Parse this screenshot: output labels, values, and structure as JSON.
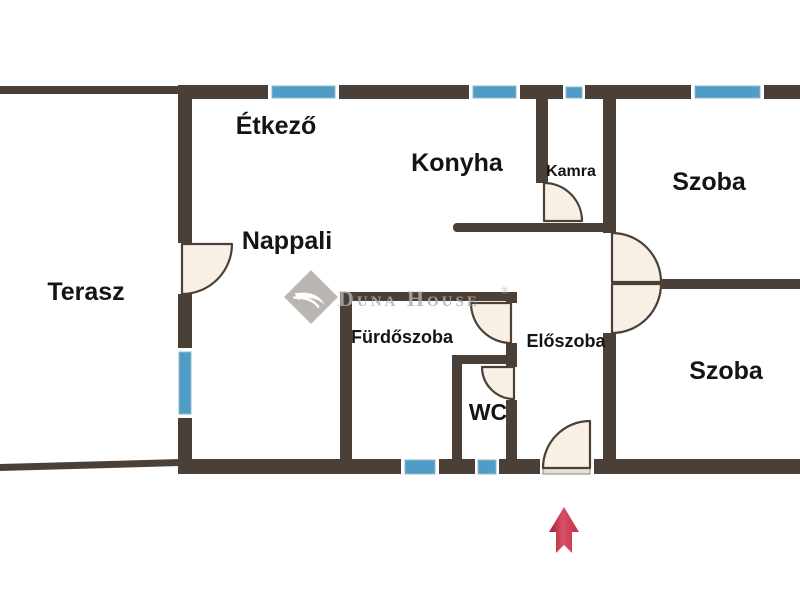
{
  "page": {
    "description": "Apartment floor plan drawing with Hungarian room labels and agency watermark"
  },
  "colors": {
    "background": "#ffffff",
    "wall": "#4a4037",
    "window": "#4f9dc6",
    "window_border": "#95b8c8",
    "door_fill": "#f8f0e5",
    "door_sill": "#e9e1d3",
    "label": "#141414",
    "watermark": "#b4afa9",
    "arrow_dark": "#9e2038",
    "arrow_mid": "#d94f63",
    "arrow_edge": "#c23049"
  },
  "rooms": [
    {
      "name": "etkezo",
      "label": "Étkező"
    },
    {
      "name": "konyha",
      "label": "Konyha"
    },
    {
      "name": "kamra",
      "label": "Kamra"
    },
    {
      "name": "szoba-top",
      "label": "Szoba"
    },
    {
      "name": "nappali",
      "label": "Nappali"
    },
    {
      "name": "terasz",
      "label": "Terasz"
    },
    {
      "name": "furdoszoba",
      "label": "Fürdőszoba"
    },
    {
      "name": "eloszoba",
      "label": "Előszoba"
    },
    {
      "name": "wc",
      "label": "WC"
    },
    {
      "name": "szoba-bottom",
      "label": "Szoba"
    }
  ],
  "watermark": {
    "brand": "Duna House",
    "registered": "®"
  },
  "icons": {
    "entrance_arrow": "up-arrow-entrance-marker"
  }
}
